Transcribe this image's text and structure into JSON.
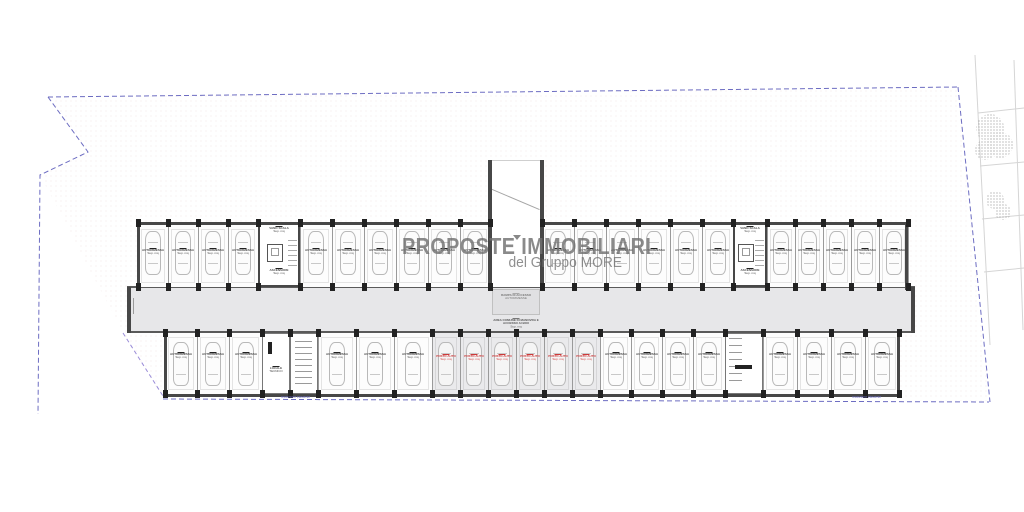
{
  "watermark": {
    "line1": "PROPOSTE IMMOBILIARI",
    "line2": "del Gruppo MORE"
  },
  "labels": {
    "stall": {
      "l1": "AUTORIMESSA",
      "l2": "Sup. mq"
    },
    "red_stall": {
      "l1": "POSTO AUTO",
      "l2": "Sup. mq"
    },
    "core": {
      "top1": "VANO SCALA",
      "top2": "Sup. mq",
      "bottom1": "ASCENSORE",
      "bottom2": "Sup. mq"
    },
    "ramp": {
      "l1": "RAMPA DI ACCESSO",
      "l2": "AUTORIMESSE"
    },
    "corridor": {
      "l1": "AREA COMUNE DI MANOVRA E ACCESSO AI BOX",
      "l2": "Sup. mq"
    },
    "tech_door": {
      "l1": "LOCALE",
      "l2": "TECNICO"
    },
    "boundary_left": "recinzione esistente",
    "boundary_right": "recinzione esistente"
  },
  "colors": {
    "wall": "#474747",
    "wallMid": "#5a5a5a",
    "pillar": "#222222",
    "divider": "#9a9a9a",
    "corridor": "#e7e7e9",
    "stallBg": "#fdfdfd",
    "redStallBg": "#eaeaec",
    "carStroke": "#b9b9b9",
    "labelText": "#4a4a4a",
    "red": "#cc3a3a",
    "boundaryBlue": "#5d5dbb",
    "boundaryPurple": "#9a8cd8"
  },
  "plan": {
    "corridor": {
      "x": 127,
      "y": 287,
      "w": 788,
      "h": 46
    },
    "topRowY": 225,
    "topRowH": 62,
    "bottomRowY": 333,
    "bottomRowH": 61,
    "topStalls": [
      [
        138,
        30
      ],
      [
        168,
        30
      ],
      [
        198,
        30
      ],
      [
        228,
        30
      ],
      [
        300,
        32
      ],
      [
        332,
        32
      ],
      [
        364,
        32
      ],
      [
        396,
        32
      ],
      [
        428,
        32
      ],
      [
        460,
        30
      ],
      [
        542,
        32
      ],
      [
        574,
        32
      ],
      [
        606,
        32
      ],
      [
        638,
        32
      ],
      [
        670,
        32
      ],
      [
        702,
        31
      ],
      [
        767,
        28
      ],
      [
        795,
        28
      ],
      [
        823,
        28
      ],
      [
        851,
        28
      ],
      [
        879,
        29
      ]
    ],
    "bottomStalls": [
      [
        165,
        32
      ],
      [
        197,
        32
      ],
      [
        229,
        33
      ],
      [
        318,
        38
      ],
      [
        356,
        38
      ],
      [
        394,
        38
      ],
      [
        600,
        31
      ],
      [
        631,
        31
      ],
      [
        662,
        31
      ],
      [
        693,
        32
      ],
      [
        763,
        34
      ],
      [
        797,
        34
      ],
      [
        831,
        34
      ],
      [
        865,
        34
      ]
    ],
    "redStalls": [
      [
        432,
        28
      ],
      [
        460,
        28
      ],
      [
        488,
        28
      ],
      [
        516,
        28
      ],
      [
        544,
        28
      ],
      [
        572,
        28
      ]
    ],
    "cores": [
      {
        "x": 258,
        "w": 42
      },
      {
        "x": 733,
        "w": 34
      }
    ],
    "tech": [
      {
        "x": 262,
        "w": 28,
        "kind": "door"
      },
      {
        "x": 290,
        "w": 28,
        "kind": "list"
      },
      {
        "x": 725,
        "w": 38,
        "kind": "listbar"
      }
    ],
    "ramp": {
      "wallA": 488,
      "wallB": 540,
      "wallW": 4,
      "topY": 160,
      "bottomY": 290,
      "innerX": 492,
      "innerW": 48
    },
    "walls": [
      [
        137,
        222,
        353,
        3
      ],
      [
        544,
        222,
        365,
        3
      ],
      [
        137,
        222,
        3,
        68
      ],
      [
        905,
        222,
        3,
        68
      ],
      [
        127,
        287,
        4,
        46
      ],
      [
        911,
        287,
        4,
        46
      ],
      [
        164,
        394,
        736,
        3
      ],
      [
        164,
        333,
        3,
        64
      ],
      [
        897,
        333,
        3,
        64
      ],
      [
        488,
        160,
        4,
        130
      ],
      [
        540,
        160,
        4,
        130
      ]
    ],
    "extraTopBoundaries": [
      258,
      300,
      490,
      542,
      733,
      767
    ],
    "extraBottomBoundaries": [
      262,
      290,
      318,
      725,
      763
    ]
  }
}
